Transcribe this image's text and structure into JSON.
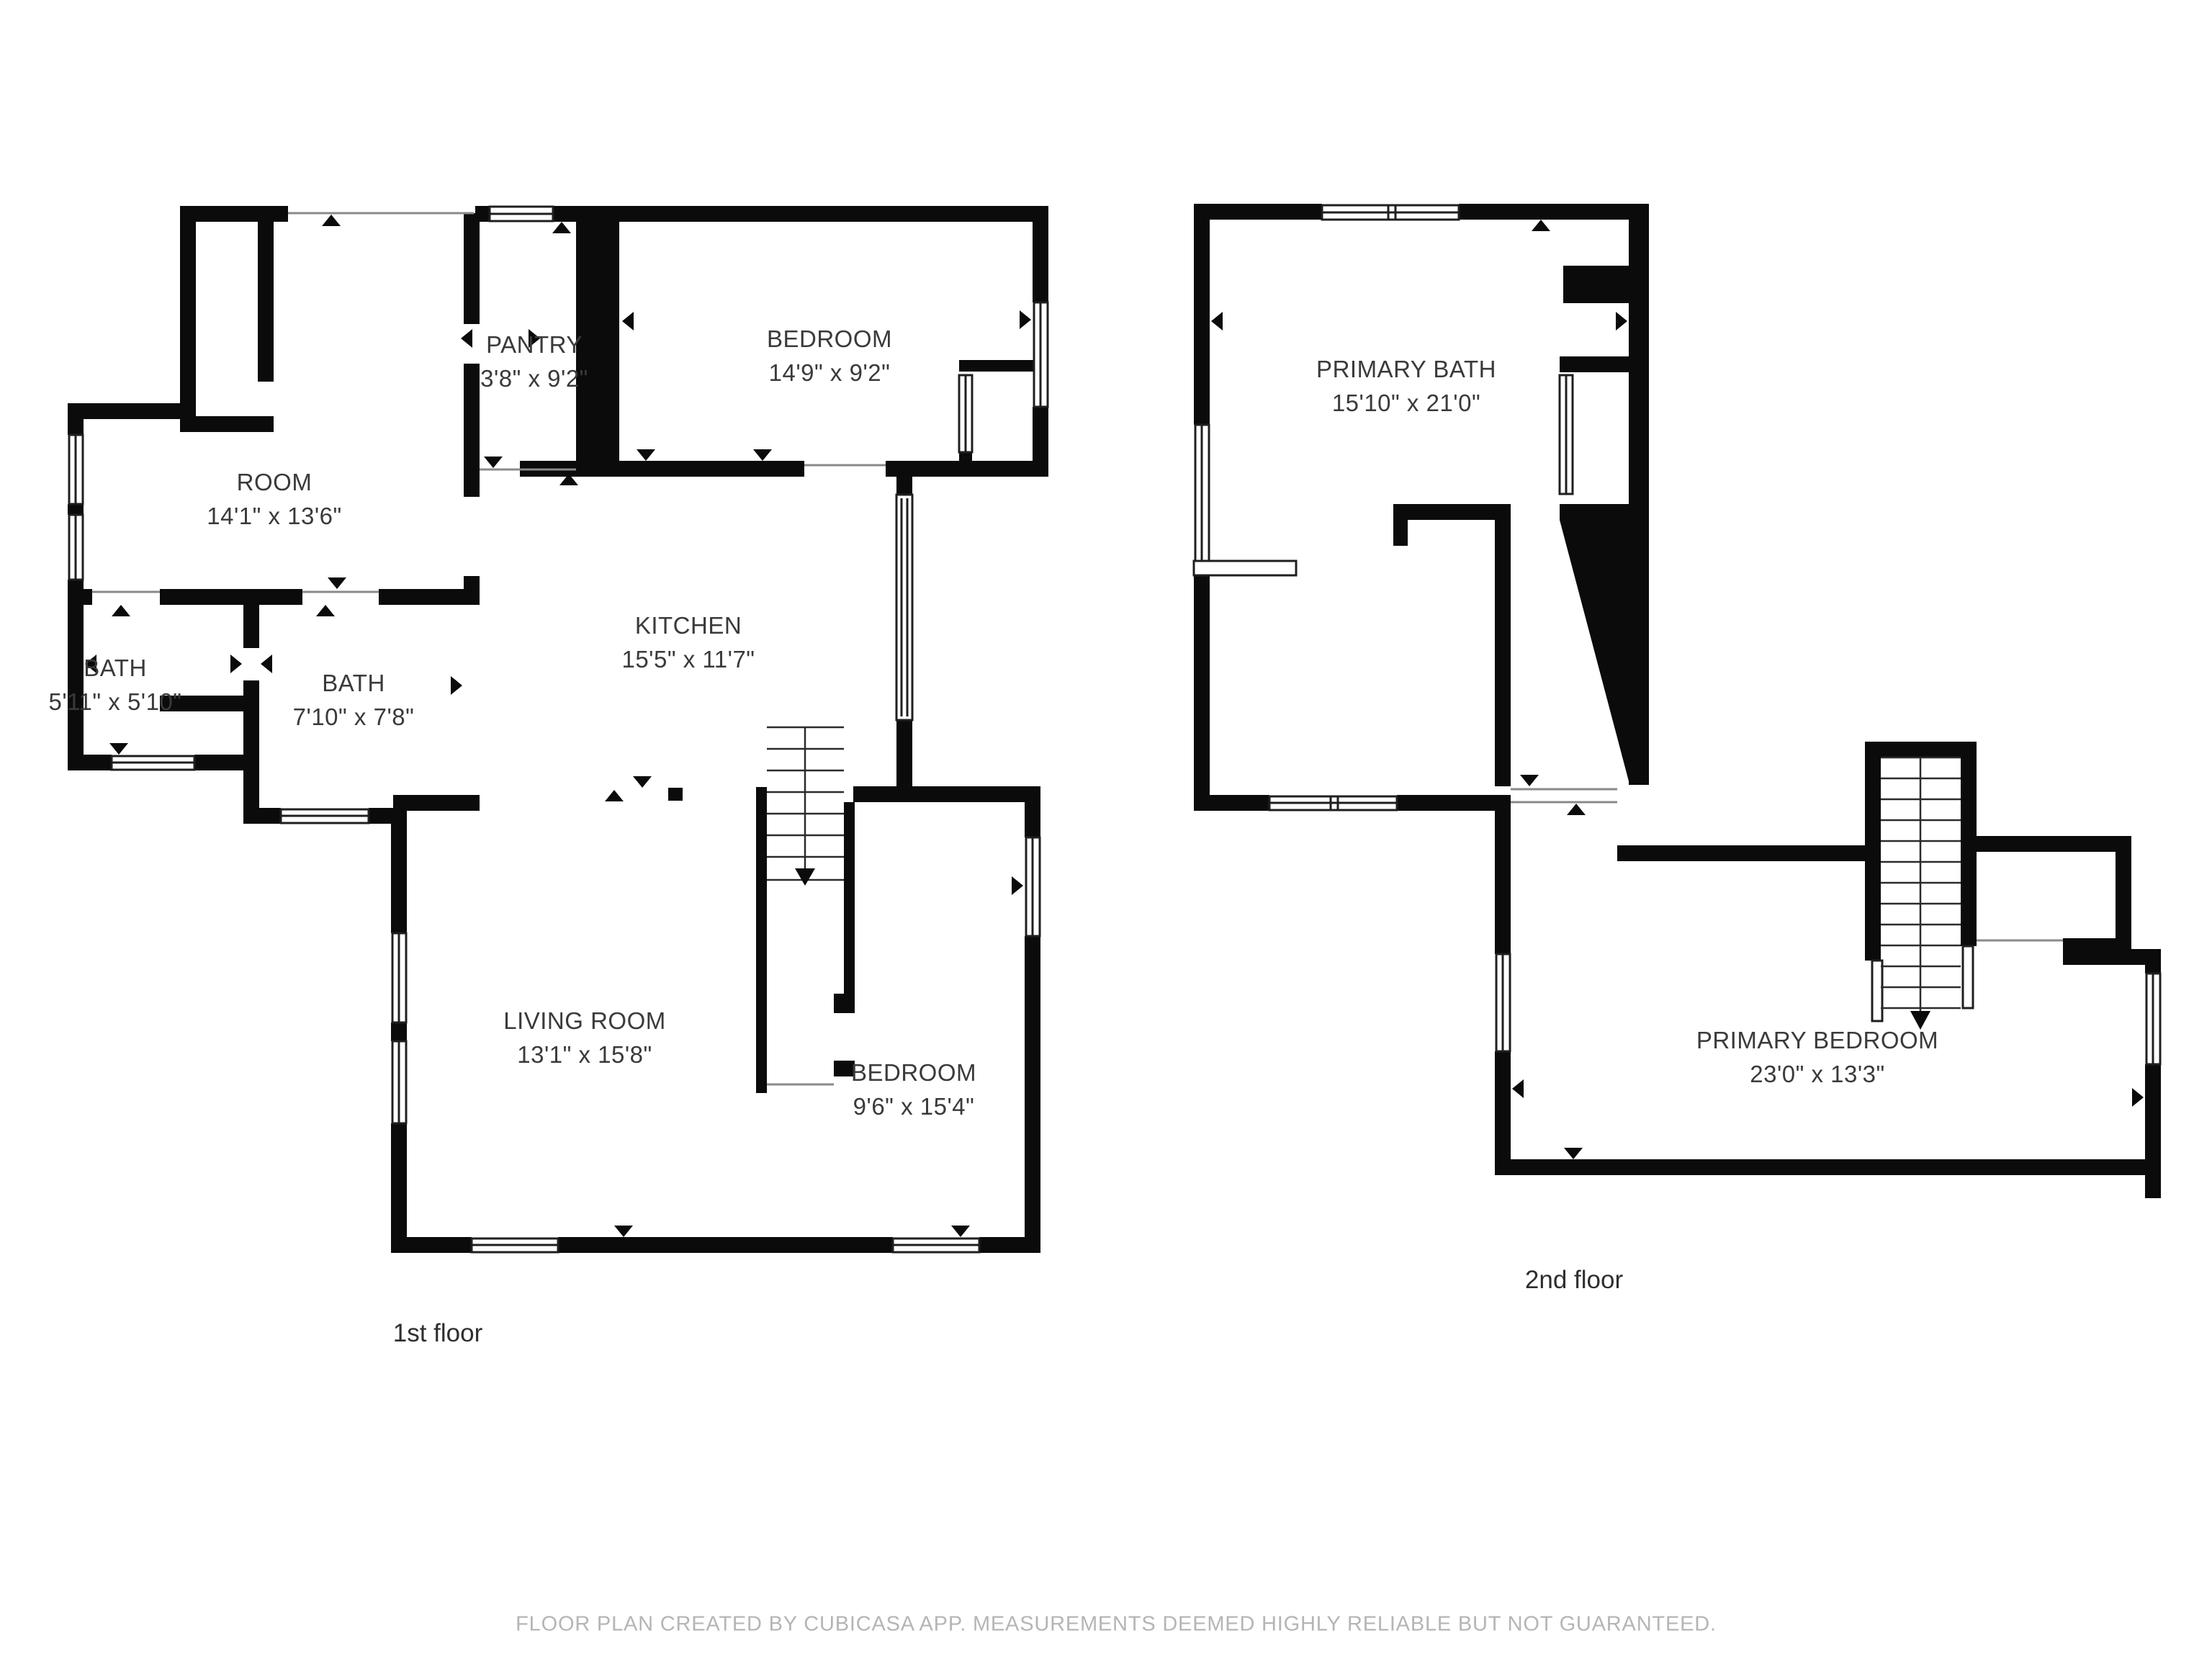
{
  "page": {
    "background": "#ffffff"
  },
  "colors": {
    "wall": "#0b0b0b",
    "thin_line": "#8a8a8a",
    "label_text": "#3a3a3a",
    "muted_text": "#b5b5b5"
  },
  "floors": [
    {
      "label": "1st floor",
      "rooms": [
        {
          "name": "ROOM",
          "dimensions": "14'1\" x 13'6\""
        },
        {
          "name": "PANTRY",
          "dimensions": "3'8\" x 9'2\""
        },
        {
          "name": "BEDROOM",
          "dimensions": "14'9\" x 9'2\""
        },
        {
          "name": "BATH",
          "dimensions": "5'11\" x 5'10\""
        },
        {
          "name": "BATH",
          "dimensions": "7'10\" x 7'8\""
        },
        {
          "name": "KITCHEN",
          "dimensions": "15'5\" x 11'7\""
        },
        {
          "name": "LIVING ROOM",
          "dimensions": "13'1\" x 15'8\""
        },
        {
          "name": "BEDROOM",
          "dimensions": "9'6\" x 15'4\""
        }
      ]
    },
    {
      "label": "2nd floor",
      "rooms": [
        {
          "name": "PRIMARY BATH",
          "dimensions": "15'10\" x 21'0\""
        },
        {
          "name": "PRIMARY BEDROOM",
          "dimensions": "23'0\" x 13'3\""
        }
      ]
    }
  ],
  "footer": {
    "disclaimer": "FLOOR PLAN CREATED BY CUBICASA APP. MEASUREMENTS DEEMED HIGHLY RELIABLE BUT NOT GUARANTEED."
  }
}
